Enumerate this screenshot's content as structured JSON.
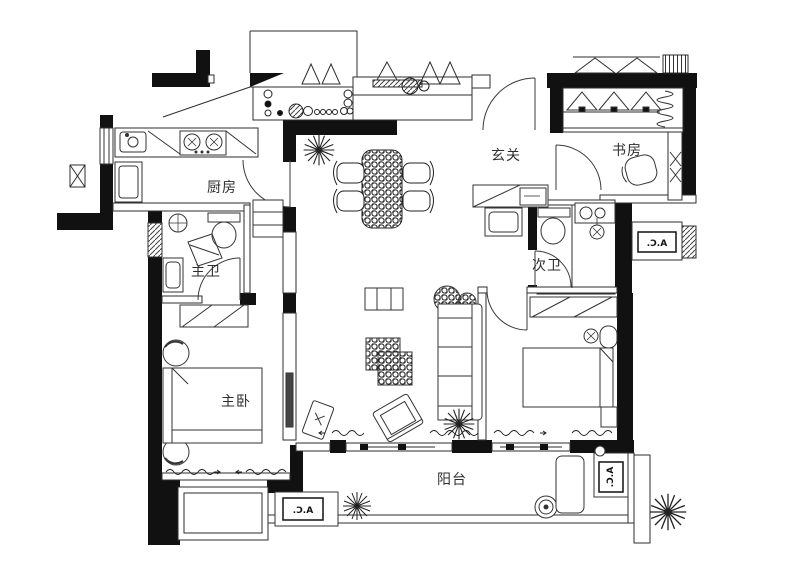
{
  "plan": {
    "title": "apartment-floor-plan",
    "rooms": {
      "kitchen": "厨房",
      "foyer": "玄关",
      "study": "书房",
      "master_bath": "主卫",
      "second_bath": "次卫",
      "master_bedroom": "主卧",
      "balcony": "阳台"
    },
    "annotations": {
      "ac_right": "A.C.",
      "ac_balcony_left": "A.C.",
      "ac_balcony_right": "A.C."
    },
    "colors": {
      "wall": "#111111",
      "line": "#3a3a3a",
      "background": "#ffffff"
    }
  }
}
